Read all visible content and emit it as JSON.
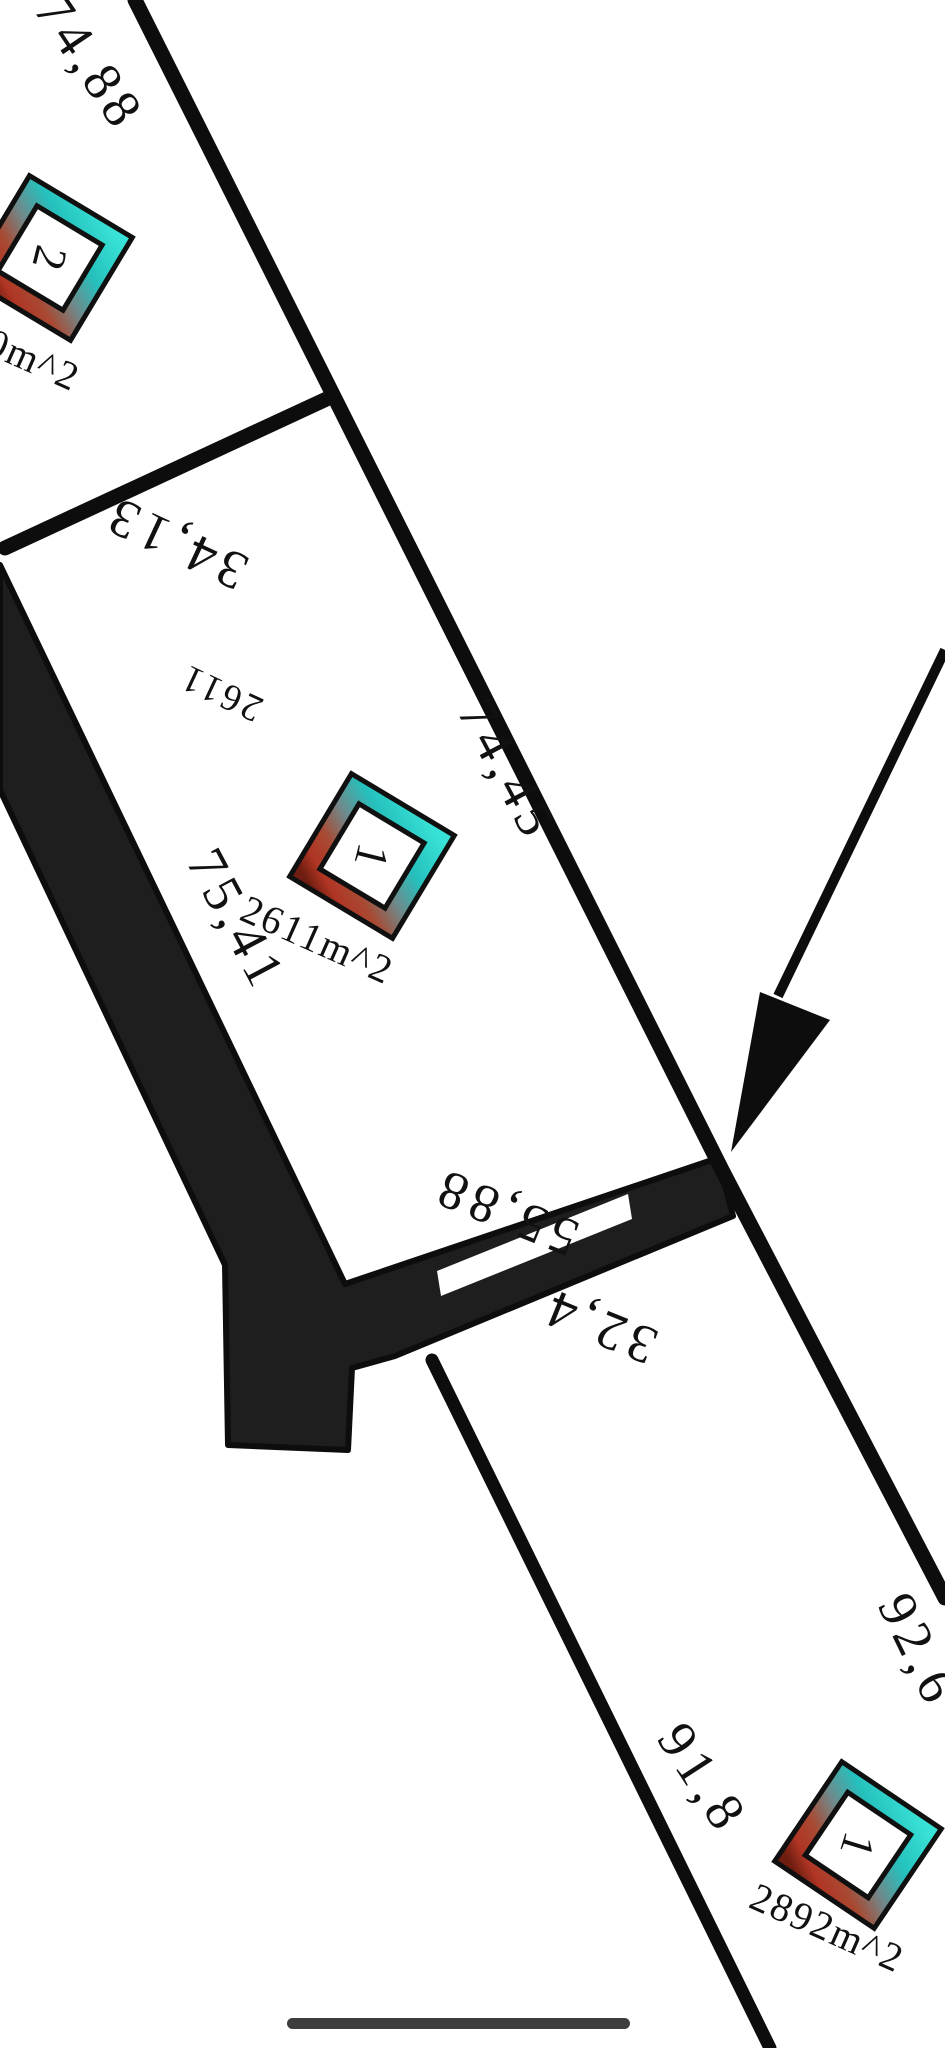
{
  "plan": {
    "type": "cadastral-parcel-plan",
    "background_color": "#ffffff",
    "line_color": "#0d0d0d",
    "road_fill_color": "#1e1e1e",
    "home_indicator_color": "#3d3d3d",
    "marker_style": {
      "shape": "rotated-square-badge",
      "gradient_top_color": "#38e2d6",
      "gradient_mid_color": "#70898b",
      "gradient_bottom_color": "#8a2214",
      "center_color": "#ffffff"
    },
    "measurements": {
      "top_left_boundary": "74,88",
      "north_boundary": "34,13",
      "east_boundary": "74,45",
      "west_road_boundary": "75,41",
      "south_boundary": "55,88",
      "road_branch_boundary": "32,4",
      "bottom_left_boundary": "91,8",
      "bottom_right_boundary": "92,6"
    },
    "parcels": {
      "parcel_center": {
        "marker_number": "1",
        "inner_number": "2611",
        "area_label": "2611m^2"
      },
      "parcel_top_left": {
        "marker_number": "2",
        "area_label_partial": "0m^2"
      },
      "parcel_bottom_right": {
        "marker_number": "1",
        "area_label": "2892m^2"
      }
    },
    "annotations": {
      "arrow": "points to junction of road and east boundary"
    }
  }
}
